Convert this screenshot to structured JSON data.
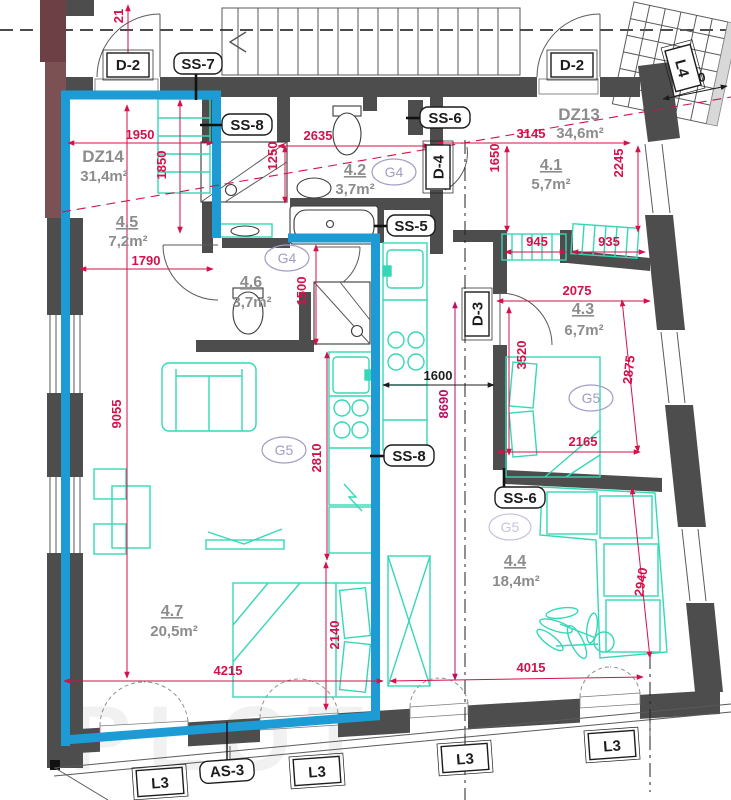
{
  "units": {
    "dz14": {
      "id": "DZ14",
      "area": "31,4m²"
    },
    "dz13": {
      "id": "DZ13",
      "area": "34,6m²"
    }
  },
  "rooms": {
    "r41": {
      "num": "4.1",
      "area": "5,7m²"
    },
    "r42": {
      "num": "4.2",
      "area": "3,7m²"
    },
    "r43": {
      "num": "4.3",
      "area": "6,7m²"
    },
    "r44": {
      "num": "4.4",
      "area": "18,4m²"
    },
    "r45": {
      "num": "4.5",
      "area": "7,2m²"
    },
    "r46": {
      "num": "4.6",
      "area": "3,7m²"
    },
    "r47": {
      "num": "4.7",
      "area": "20,5m²"
    }
  },
  "tags": {
    "d2": "D-2",
    "d3": "D-3",
    "d4": "D-4",
    "ss5": "SS-5",
    "ss6": "SS-6",
    "ss7": "SS-7",
    "ss8": "SS-8",
    "as3": "AS-3",
    "l3": "L3",
    "l4": "L4"
  },
  "groups": {
    "g4": "G4",
    "g5": "G5"
  },
  "dims": {
    "d21": "21",
    "d790": "790",
    "d935": "935",
    "d945": "945",
    "d1250": "1250",
    "d1500": "1500",
    "d1600": "1600",
    "d1650": "1650",
    "d1790": "1790",
    "d1850": "1850",
    "d1950": "1950",
    "d2075": "2075",
    "d2140": "2140",
    "d2165": "2165",
    "d2245": "2245",
    "d2635": "2635",
    "d2810": "2810",
    "d2875": "2875",
    "d2940": "2940",
    "d3145": "3145",
    "d3520": "3520",
    "d4015": "4015",
    "d4215": "4215",
    "d8690": "8690",
    "d9055": "9055"
  },
  "watermark": "PLOT",
  "colors": {
    "wall": "#4e4d4d",
    "maroon": "#7b5154",
    "highlight_blue": "#1d9bd5",
    "dimension_red": "#d5104a",
    "dimension_magenta": "#bd0d62",
    "furniture_cyan": "#35d8b6",
    "room_label_gray": "#8c8c8c",
    "group_purple": "#a39cc4"
  }
}
